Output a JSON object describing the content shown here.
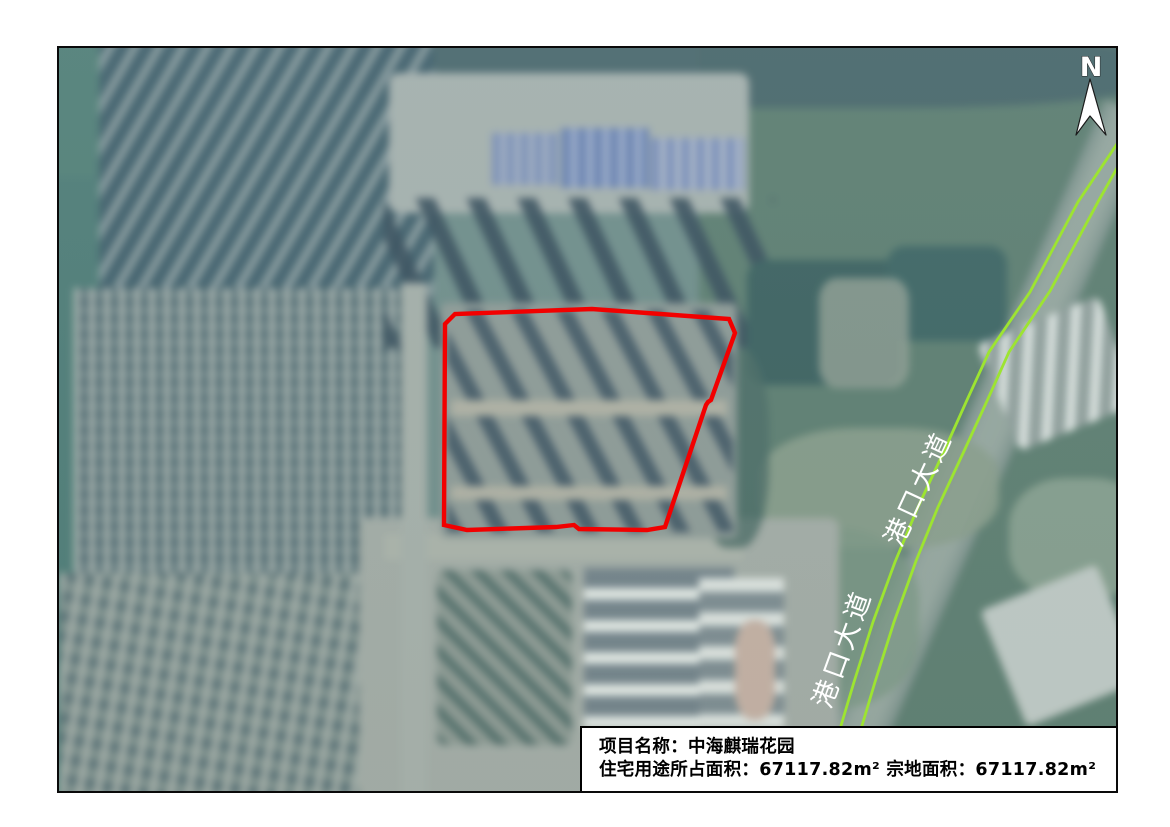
{
  "map": {
    "north_indicator": {
      "label": "N"
    },
    "road": {
      "name": "港口大道",
      "labels": [
        "港口大道",
        "港口大道"
      ],
      "line_color": "#9de431",
      "label_color": "#ffffff"
    },
    "parcel_boundary": {
      "color": "#f20000"
    },
    "info_box": {
      "line1": "项目名称：中海麒瑞花园",
      "line2": "住宅用途所占面积：67117.82m² 宗地面积：67117.82m²",
      "project_name": "中海麒瑞花园",
      "residential_area": "67117.82m²",
      "parcel_area": "67117.82m²"
    }
  }
}
